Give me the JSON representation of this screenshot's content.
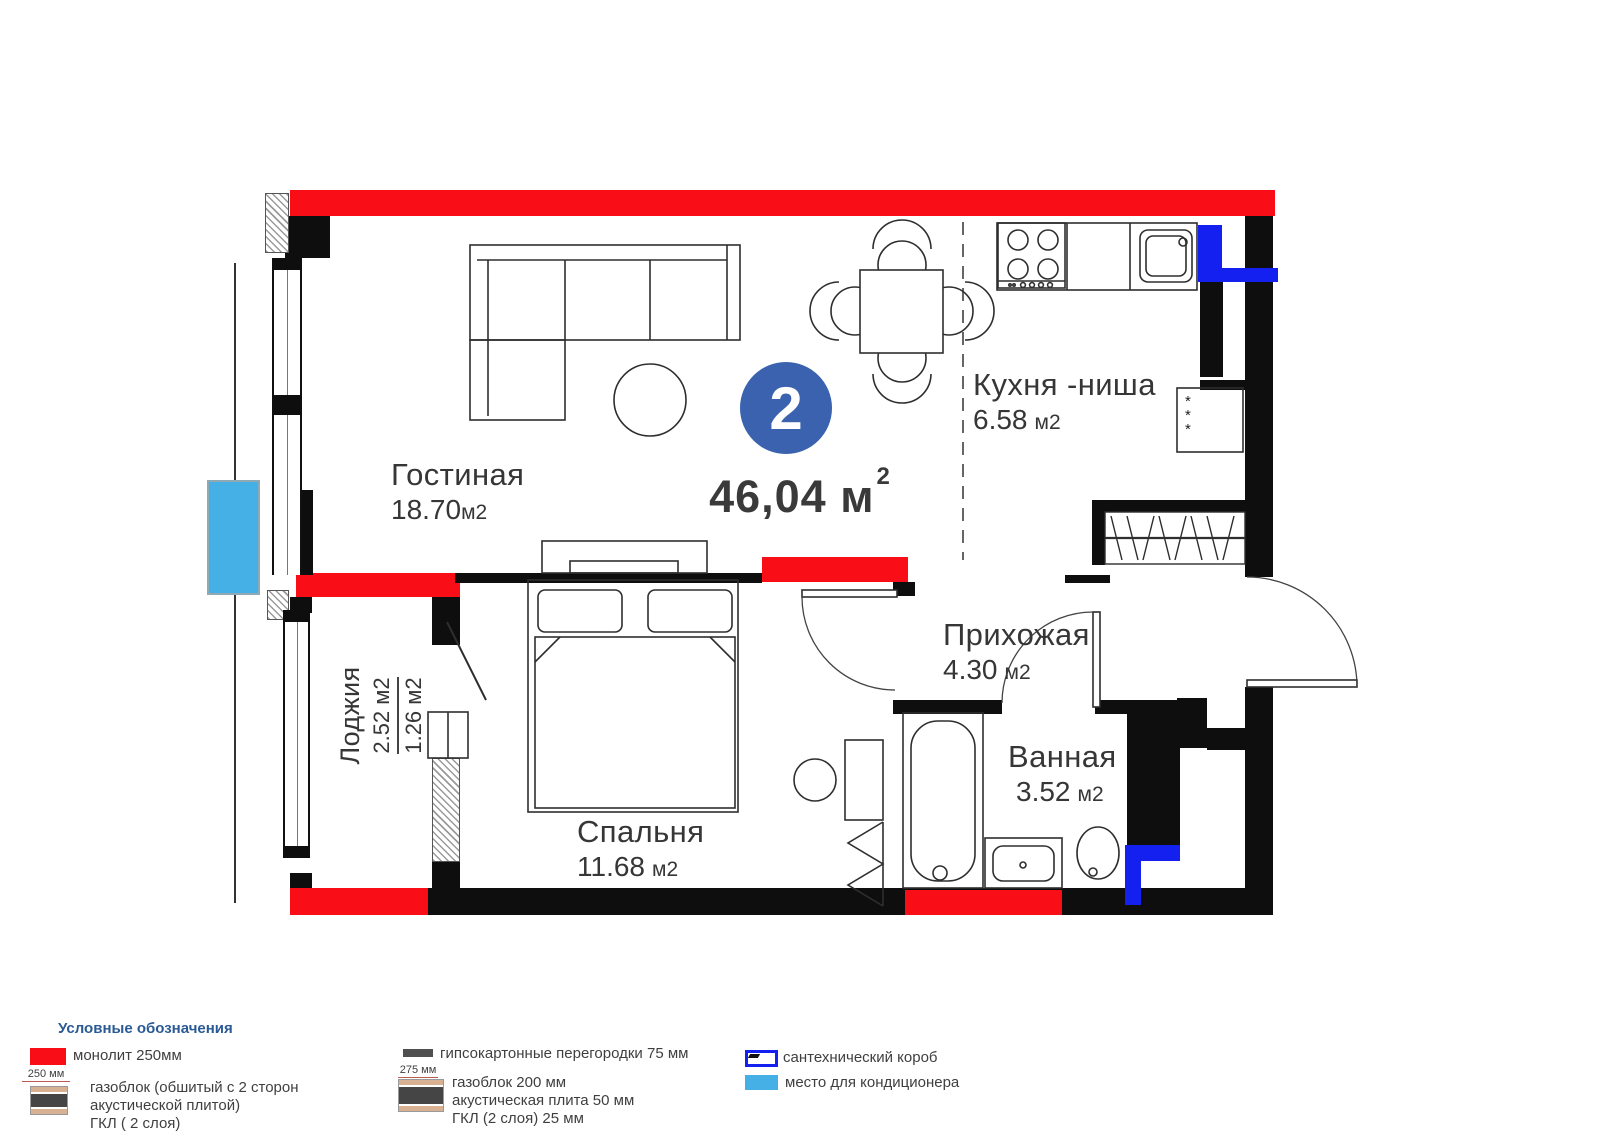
{
  "plan": {
    "badge": "2",
    "total_area": {
      "value": "46,04",
      "unit": "м",
      "sup": "2"
    },
    "rooms": {
      "living": {
        "name": "Гостиная",
        "area": "18.70",
        "unit": "м2"
      },
      "kitchen": {
        "name": "Кухня -ниша",
        "area": "6.58",
        "unit": "м2"
      },
      "hall": {
        "name": "Прихожая",
        "area": "4.30",
        "unit": "м2"
      },
      "bath": {
        "name": "Ванная",
        "area": "3.52",
        "unit": "м2"
      },
      "bedroom": {
        "name": "Спальня",
        "area": "11.68",
        "unit": "м2"
      },
      "loggia": {
        "name": "Лоджия",
        "area_full": "2.52 м2",
        "area_reduced": "1.26 м2"
      }
    },
    "fridge_mark": "*\n*\n*"
  },
  "legend": {
    "title": "Условные обозначения",
    "monolith": "монолит 250мм",
    "dim_250": "250 мм",
    "gasblock_lines": [
      "газоблок (обшитый с 2 сторон",
      "акустической плитой)",
      "ГКЛ ( 2 слоя)"
    ],
    "gypsum": "гипсокартонные перегородки 75 мм",
    "dim_275": "275 мм",
    "gasblock200_lines": [
      "газоблок 200 мм",
      "акустическая плита 50 мм",
      "ГКЛ (2 слоя) 25 мм"
    ],
    "plumb_box": "сантехнический короб",
    "ac_place": "место для кондиционера"
  },
  "colors": {
    "monolith_red": "#F90D17",
    "badge_blue": "#3A62AE",
    "plumb_blue": "#1420F0",
    "ac_blue": "#45B0E5",
    "legend_header": "#2A5A96"
  }
}
